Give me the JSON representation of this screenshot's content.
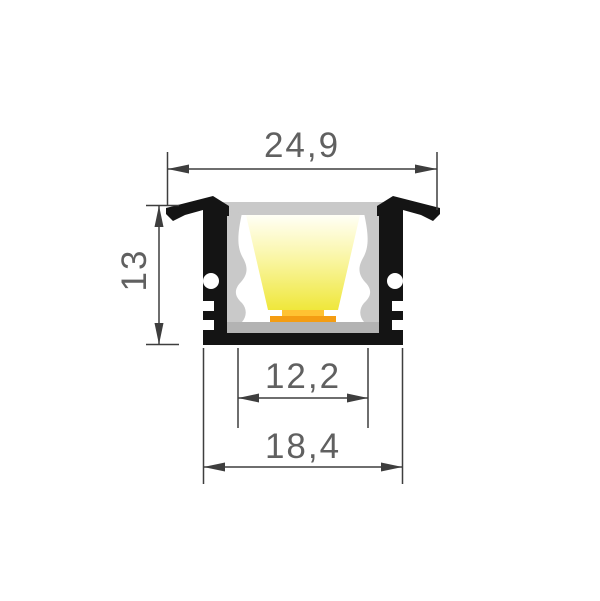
{
  "drawing": {
    "type": "technical-cross-section",
    "dimensions": {
      "top_width": {
        "label": "24,9"
      },
      "height": {
        "label": "13"
      },
      "inner_width": {
        "label": "12,2"
      },
      "bottom_width": {
        "label": "18,4"
      }
    },
    "colors": {
      "background": "#FFFFFF",
      "profile_body": "#141414",
      "diffuser": "#C9C9C9",
      "diffuser_floor": "#B3B3B3",
      "interior": "#FFFFFF",
      "beam_top": "#FFFFF6",
      "beam_mid": "#FAF6A6",
      "beam_bottom": "#EFE73B",
      "led_base": "#F49D13",
      "led_chip": "#FFC232",
      "dim_line": "#3E3E3E",
      "dim_text": "#606060"
    }
  }
}
